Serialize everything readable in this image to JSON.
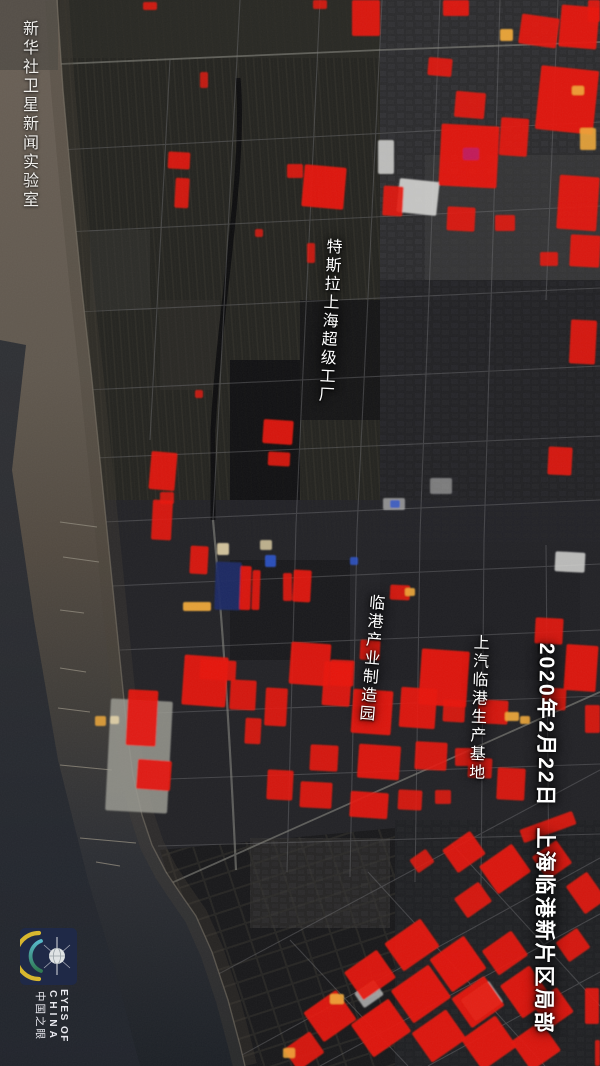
{
  "watermark": "新华社卫星新闻实验室",
  "annotations": {
    "tesla": "特斯拉上海超级工厂",
    "industry_park": "临港产业制造园",
    "saic_base": "上汽临港生产基地"
  },
  "caption": {
    "date": "2020年2月22日",
    "location": "上海临港新片区局部"
  },
  "logo": {
    "line1": "EYES OF",
    "line2": "CHINA",
    "line3": "中国之眼"
  },
  "map": {
    "palette": {
      "r": "#e8160b",
      "R": "#b5120a",
      "y": "#f0a93a",
      "m": "#c01a5f",
      "b": "#2f55cc",
      "B": "#1b2a66",
      "w": "#d6d6d4",
      "W": "#9a9a92",
      "c": "#e3d3a8",
      "sea_top": "#6b6157",
      "sea_bottom": "#1d2127",
      "land": "#222225",
      "heat_color_meaning": "red = active/heat areas"
    },
    "heat_spots": [
      [
        108,
        700,
        62,
        112,
        3,
        "W",
        0.85
      ],
      [
        398,
        180,
        40,
        34,
        6,
        "w",
        0.9
      ],
      [
        378,
        140,
        16,
        34,
        0,
        "w",
        0.85
      ],
      [
        555,
        552,
        30,
        20,
        3,
        "w",
        0.85
      ],
      [
        465,
        988,
        34,
        26,
        -35,
        "w",
        0.8
      ],
      [
        357,
        985,
        24,
        18,
        -35,
        "w",
        0.7
      ],
      [
        430,
        478,
        22,
        16,
        0,
        "w",
        0.5
      ],
      [
        383,
        498,
        22,
        12,
        0,
        "w",
        0.6
      ],
      [
        390,
        500,
        10,
        8,
        0,
        "b",
        0.8
      ],
      [
        217,
        543,
        12,
        12,
        0,
        "c",
        0.9
      ],
      [
        260,
        540,
        12,
        10,
        0,
        "c",
        0.8
      ],
      [
        110,
        716,
        9,
        8,
        0,
        "c",
        0.9
      ],
      [
        183,
        602,
        28,
        9,
        0,
        "y",
        0.95
      ],
      [
        215,
        562,
        26,
        48,
        2,
        "B",
        0.95
      ],
      [
        265,
        555,
        11,
        12,
        0,
        "b",
        0.9
      ],
      [
        350,
        557,
        8,
        8,
        0,
        "b",
        0.85
      ],
      [
        352,
        0,
        28,
        36,
        0,
        "r",
        0.92
      ],
      [
        443,
        0,
        26,
        16,
        0,
        "r",
        0.92
      ],
      [
        520,
        16,
        38,
        30,
        8,
        "r",
        0.92
      ],
      [
        560,
        6,
        38,
        42,
        5,
        "r",
        0.95
      ],
      [
        500,
        29,
        13,
        12,
        0,
        "y",
        0.95
      ],
      [
        588,
        0,
        12,
        22,
        0,
        "r",
        0.9
      ],
      [
        428,
        58,
        24,
        18,
        5,
        "r",
        0.9
      ],
      [
        455,
        92,
        30,
        26,
        5,
        "r",
        0.9
      ],
      [
        538,
        68,
        58,
        64,
        6,
        "r",
        0.95
      ],
      [
        580,
        128,
        16,
        22,
        0,
        "y",
        0.9
      ],
      [
        500,
        118,
        28,
        38,
        4,
        "r",
        0.92
      ],
      [
        440,
        125,
        58,
        62,
        3,
        "r",
        0.95
      ],
      [
        463,
        148,
        16,
        12,
        0,
        "m",
        0.95
      ],
      [
        558,
        176,
        40,
        54,
        4,
        "r",
        0.93
      ],
      [
        572,
        86,
        12,
        9,
        0,
        "y",
        0.9
      ],
      [
        447,
        207,
        28,
        24,
        3,
        "r",
        0.9
      ],
      [
        495,
        215,
        20,
        16,
        0,
        "r",
        0.88
      ],
      [
        570,
        235,
        30,
        32,
        3,
        "r",
        0.92
      ],
      [
        540,
        252,
        18,
        14,
        0,
        "r",
        0.88
      ],
      [
        383,
        186,
        20,
        30,
        3,
        "r",
        0.9
      ],
      [
        143,
        2,
        14,
        8,
        0,
        "r",
        0.85
      ],
      [
        313,
        0,
        14,
        9,
        0,
        "r",
        0.85
      ],
      [
        168,
        152,
        22,
        17,
        3,
        "r",
        0.9
      ],
      [
        175,
        178,
        14,
        30,
        3,
        "r",
        0.88
      ],
      [
        200,
        72,
        8,
        16,
        0,
        "r",
        0.8
      ],
      [
        287,
        164,
        16,
        14,
        0,
        "r",
        0.88
      ],
      [
        303,
        166,
        42,
        42,
        5,
        "r",
        0.95
      ],
      [
        255,
        229,
        8,
        8,
        0,
        "r",
        0.8
      ],
      [
        307,
        243,
        8,
        20,
        0,
        "r",
        0.82
      ],
      [
        195,
        390,
        8,
        8,
        0,
        "r",
        0.8
      ],
      [
        263,
        420,
        30,
        24,
        4,
        "r",
        0.92
      ],
      [
        268,
        452,
        22,
        14,
        3,
        "r",
        0.88
      ],
      [
        150,
        452,
        26,
        38,
        5,
        "r",
        0.92
      ],
      [
        160,
        492,
        14,
        12,
        0,
        "r",
        0.85
      ],
      [
        570,
        320,
        26,
        44,
        3,
        "r",
        0.9
      ],
      [
        548,
        447,
        24,
        28,
        3,
        "r",
        0.9
      ],
      [
        240,
        566,
        11,
        44,
        2,
        "r",
        0.92
      ],
      [
        252,
        570,
        8,
        40,
        2,
        "r",
        0.9
      ],
      [
        283,
        573,
        9,
        28,
        0,
        "r",
        0.88
      ],
      [
        293,
        570,
        18,
        32,
        3,
        "r",
        0.92
      ],
      [
        190,
        546,
        18,
        28,
        3,
        "r",
        0.9
      ],
      [
        152,
        500,
        20,
        40,
        3,
        "r",
        0.9
      ],
      [
        290,
        643,
        40,
        42,
        4,
        "r",
        0.93
      ],
      [
        330,
        660,
        24,
        26,
        3,
        "r",
        0.9
      ],
      [
        183,
        656,
        44,
        50,
        4,
        "r",
        0.93
      ],
      [
        230,
        680,
        26,
        30,
        3,
        "r",
        0.9
      ],
      [
        323,
        662,
        28,
        44,
        4,
        "r",
        0.92
      ],
      [
        360,
        640,
        20,
        20,
        3,
        "r",
        0.88
      ],
      [
        352,
        690,
        40,
        44,
        4,
        "r",
        0.94
      ],
      [
        400,
        688,
        36,
        40,
        4,
        "r",
        0.93
      ],
      [
        310,
        745,
        28,
        26,
        3,
        "r",
        0.9
      ],
      [
        358,
        745,
        42,
        34,
        4,
        "r",
        0.93
      ],
      [
        415,
        742,
        32,
        28,
        3,
        "r",
        0.9
      ],
      [
        300,
        782,
        32,
        26,
        3,
        "r",
        0.9
      ],
      [
        350,
        792,
        38,
        26,
        4,
        "r",
        0.92
      ],
      [
        398,
        790,
        24,
        20,
        3,
        "r",
        0.88
      ],
      [
        443,
        700,
        22,
        22,
        3,
        "r",
        0.88
      ],
      [
        455,
        748,
        20,
        18,
        0,
        "r",
        0.86
      ],
      [
        435,
        790,
        16,
        14,
        0,
        "r",
        0.85
      ],
      [
        390,
        585,
        20,
        15,
        3,
        "r",
        0.88
      ],
      [
        405,
        588,
        10,
        8,
        0,
        "y",
        0.9
      ],
      [
        420,
        650,
        48,
        56,
        4,
        "r",
        0.95
      ],
      [
        478,
        700,
        30,
        24,
        3,
        "r",
        0.9
      ],
      [
        505,
        712,
        14,
        9,
        0,
        "y",
        0.92
      ],
      [
        468,
        758,
        24,
        20,
        3,
        "r",
        0.88
      ],
      [
        497,
        768,
        28,
        32,
        3,
        "r",
        0.9
      ],
      [
        535,
        618,
        28,
        26,
        3,
        "r",
        0.9
      ],
      [
        565,
        645,
        32,
        46,
        4,
        "r",
        0.93
      ],
      [
        542,
        688,
        24,
        22,
        3,
        "r",
        0.88
      ],
      [
        585,
        705,
        15,
        28,
        0,
        "r",
        0.88
      ],
      [
        520,
        716,
        10,
        8,
        0,
        "y",
        0.9
      ],
      [
        127,
        690,
        30,
        56,
        3,
        "r",
        0.93
      ],
      [
        137,
        760,
        34,
        30,
        4,
        "r",
        0.92
      ],
      [
        200,
        660,
        36,
        20,
        3,
        "r",
        0.9
      ],
      [
        245,
        718,
        16,
        26,
        3,
        "r",
        0.88
      ],
      [
        265,
        688,
        22,
        38,
        3,
        "r",
        0.9
      ],
      [
        267,
        770,
        26,
        30,
        3,
        "r",
        0.9
      ],
      [
        95,
        716,
        11,
        10,
        0,
        "y",
        0.85
      ],
      [
        447,
        838,
        34,
        28,
        -35,
        "r",
        0.92
      ],
      [
        485,
        852,
        40,
        34,
        -35,
        "r",
        0.93
      ],
      [
        537,
        846,
        30,
        28,
        -35,
        "r",
        0.9
      ],
      [
        573,
        876,
        26,
        34,
        -35,
        "r",
        0.9
      ],
      [
        458,
        888,
        30,
        24,
        -35,
        "r",
        0.9
      ],
      [
        412,
        853,
        20,
        16,
        -35,
        "r",
        0.86
      ],
      [
        560,
        933,
        26,
        24,
        -35,
        "r",
        0.9
      ],
      [
        520,
        820,
        56,
        14,
        -20,
        "r",
        0.88
      ],
      [
        390,
        928,
        44,
        34,
        -35,
        "r",
        0.94
      ],
      [
        437,
        944,
        42,
        40,
        -35,
        "r",
        0.95
      ],
      [
        487,
        938,
        36,
        30,
        -35,
        "r",
        0.92
      ],
      [
        350,
        958,
        40,
        34,
        -35,
        "r",
        0.93
      ],
      [
        398,
        974,
        46,
        40,
        -35,
        "r",
        0.95
      ],
      [
        458,
        984,
        40,
        36,
        -35,
        "r",
        0.94
      ],
      [
        508,
        972,
        36,
        40,
        -35,
        "r",
        0.93
      ],
      [
        310,
        998,
        40,
        36,
        -35,
        "r",
        0.93
      ],
      [
        358,
        1008,
        46,
        40,
        -35,
        "r",
        0.95
      ],
      [
        418,
        1018,
        42,
        36,
        -35,
        "r",
        0.94
      ],
      [
        468,
        1024,
        42,
        38,
        -35,
        "r",
        0.94
      ],
      [
        518,
        1028,
        36,
        36,
        -35,
        "r",
        0.93
      ],
      [
        288,
        1038,
        32,
        26,
        -35,
        "r",
        0.9
      ],
      [
        538,
        993,
        30,
        30,
        -35,
        "r",
        0.92
      ],
      [
        330,
        994,
        14,
        10,
        0,
        "y",
        0.9
      ],
      [
        283,
        1048,
        12,
        10,
        0,
        "y",
        0.88
      ],
      [
        585,
        988,
        14,
        36,
        0,
        "r",
        0.9
      ],
      [
        595,
        1040,
        5,
        26,
        0,
        "r",
        0.85
      ]
    ]
  }
}
